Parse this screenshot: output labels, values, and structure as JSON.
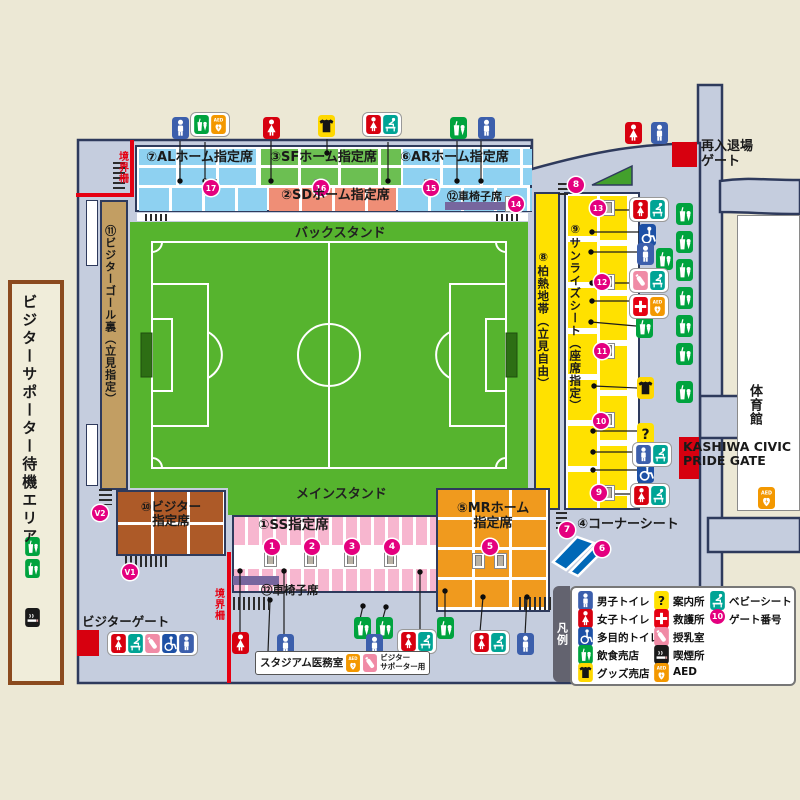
{
  "colors": {
    "background": "#ECE8D5",
    "concourse": "#C5CDDE",
    "outline": "#2E3A5C",
    "stand_blue": "#8ED1F1",
    "stand_green": "#6CBF52",
    "stand_salmon": "#EF8E76",
    "stand_pink": "#F7B6CF",
    "stand_orange": "#F09A1E",
    "stand_brown": "#AD5A28",
    "stand_tan": "#C29E63",
    "stand_yellow": "#FFE100",
    "field_green": "#56B42E",
    "gate_red": "#E60012",
    "gate_number_pink": "#E4007F",
    "wheelchair_bar_purple": "#77669E",
    "corner_seat_blue": "#0068B7"
  },
  "labels": {
    "back_stand": "バックスタンド",
    "main_stand": "メインスタンド",
    "reentry_gate": "再入退場\nゲート",
    "boundary_fence": "境界柵",
    "visitor_gate": "ビジターゲート",
    "visitor_waiting_area": "ビジターサポーター待機エリア",
    "stadium_medical_room": "スタジアム医務室",
    "for_visitor_supporters": "ビジター\nサポーター用",
    "kashiwa_civic_pride_gate": "KASHIWA CIVIC\nPRIDE GATE",
    "gymnasium": "体育館"
  },
  "stands": {
    "al": "⑦ALホーム指定席",
    "sf": "③SFホーム指定席",
    "ar": "⑥ARホーム指定席",
    "sd": "②SDホーム指定席",
    "wheelchair_top": "⑫車椅子席",
    "kashiwa_hot_zone": "⑧柏熱地帯（立見自由）",
    "sunrise_seat": "⑨サンライズシート（座席指定）",
    "visitor_goal_back": "⑪ビジターゴール裏（立見指定）",
    "visitor_reserved": "⑩ビジター\n指定席",
    "ss_reserved": "①SS指定席",
    "wheelchair_bottom": "⑫車椅子席",
    "mr_home": "⑤MRホーム\n指定席",
    "corner_seat": "④コーナーシート"
  },
  "legend": {
    "title": "凡例",
    "col1": [
      {
        "icon": "male",
        "label": "男子トイレ"
      },
      {
        "icon": "female",
        "label": "女子トイレ"
      },
      {
        "icon": "wheelchair",
        "label": "多目的トイレ"
      },
      {
        "icon": "food",
        "label": "飲食売店"
      },
      {
        "icon": "goods",
        "label": "グッズ売店"
      }
    ],
    "col2": [
      {
        "icon": "info",
        "label": "案内所"
      },
      {
        "icon": "firstaid",
        "label": "救護所"
      },
      {
        "icon": "nursing",
        "label": "授乳室"
      },
      {
        "icon": "smoking",
        "label": "喫煙所"
      },
      {
        "icon": "aed",
        "label": "AED"
      }
    ],
    "col3": [
      {
        "icon": "babyseat",
        "label": "ベビーシート"
      },
      {
        "icon": "gate10",
        "label": "ゲート番号"
      }
    ]
  },
  "gates": [
    {
      "n": "1",
      "x": 272,
      "y": 547
    },
    {
      "n": "2",
      "x": 312,
      "y": 547
    },
    {
      "n": "3",
      "x": 352,
      "y": 547
    },
    {
      "n": "4",
      "x": 392,
      "y": 547
    },
    {
      "n": "5",
      "x": 490,
      "y": 547
    },
    {
      "n": "6",
      "x": 602,
      "y": 549
    },
    {
      "n": "7",
      "x": 567,
      "y": 530
    },
    {
      "n": "8",
      "x": 576,
      "y": 185
    },
    {
      "n": "9",
      "x": 599,
      "y": 493
    },
    {
      "n": "10",
      "x": 601,
      "y": 421
    },
    {
      "n": "11",
      "x": 602,
      "y": 351
    },
    {
      "n": "12",
      "x": 602,
      "y": 282
    },
    {
      "n": "13",
      "x": 598,
      "y": 208
    },
    {
      "n": "14",
      "x": 516,
      "y": 204
    },
    {
      "n": "15",
      "x": 431,
      "y": 188
    },
    {
      "n": "16",
      "x": 321,
      "y": 188
    },
    {
      "n": "17",
      "x": 211,
      "y": 188
    },
    {
      "n": "V1",
      "x": 130,
      "y": 572
    },
    {
      "n": "V2",
      "x": 100,
      "y": 513
    }
  ],
  "map_icons": [
    {
      "t": "male",
      "x": 172,
      "y": 117
    },
    {
      "t": "female",
      "x": 263,
      "y": 117
    },
    {
      "t": "goods",
      "x": 318,
      "y": 115
    },
    {
      "t": "food",
      "x": 450,
      "y": 117
    },
    {
      "t": "male",
      "x": 478,
      "y": 117
    },
    {
      "t": "female",
      "x": 625,
      "y": 122
    },
    {
      "t": "male",
      "x": 651,
      "y": 122
    },
    {
      "t": "food",
      "x": 676,
      "y": 203
    },
    {
      "t": "food",
      "x": 676,
      "y": 231
    },
    {
      "t": "food",
      "x": 676,
      "y": 259
    },
    {
      "t": "food",
      "x": 676,
      "y": 287
    },
    {
      "t": "food",
      "x": 676,
      "y": 315
    },
    {
      "t": "food",
      "x": 676,
      "y": 343
    },
    {
      "t": "food",
      "x": 676,
      "y": 381
    },
    {
      "t": "wheelchair",
      "x": 639,
      "y": 224
    },
    {
      "t": "male",
      "x": 637,
      "y": 243
    },
    {
      "t": "food",
      "x": 656,
      "y": 248
    },
    {
      "t": "food",
      "x": 636,
      "y": 316
    },
    {
      "t": "goods",
      "x": 637,
      "y": 377
    },
    {
      "t": "info",
      "x": 637,
      "y": 423
    },
    {
      "t": "wheelchair",
      "x": 637,
      "y": 461
    },
    {
      "t": "food",
      "x": 25,
      "y": 537,
      "w": 15,
      "h": 19
    },
    {
      "t": "food",
      "x": 25,
      "y": 559,
      "w": 15,
      "h": 19
    },
    {
      "t": "smoking",
      "x": 25,
      "y": 608,
      "w": 15,
      "h": 19
    },
    {
      "t": "female",
      "x": 232,
      "y": 632
    },
    {
      "t": "male",
      "x": 277,
      "y": 634
    },
    {
      "t": "food",
      "x": 354,
      "y": 617
    },
    {
      "t": "food",
      "x": 376,
      "y": 617
    },
    {
      "t": "male",
      "x": 366,
      "y": 634
    },
    {
      "t": "food",
      "x": 437,
      "y": 617
    },
    {
      "t": "male",
      "x": 517,
      "y": 633
    },
    {
      "t": "aed",
      "x": 758,
      "y": 487
    }
  ],
  "pills": [
    {
      "x": 190,
      "y": 112,
      "icons": [
        "food",
        "aed"
      ]
    },
    {
      "x": 362,
      "y": 112,
      "icons": [
        "female",
        "babyseat"
      ]
    },
    {
      "x": 629,
      "y": 197,
      "icons": [
        "female",
        "babyseat"
      ]
    },
    {
      "x": 629,
      "y": 268,
      "icons": [
        "nursing",
        "babyseat"
      ]
    },
    {
      "x": 629,
      "y": 294,
      "icons": [
        "firstaid",
        "aed"
      ]
    },
    {
      "x": 632,
      "y": 442,
      "icons": [
        "male",
        "babyseat"
      ]
    },
    {
      "x": 630,
      "y": 483,
      "icons": [
        "female",
        "babyseat"
      ]
    },
    {
      "x": 397,
      "y": 629,
      "icons": [
        "female",
        "babyseat"
      ]
    },
    {
      "x": 470,
      "y": 630,
      "icons": [
        "female",
        "babyseat"
      ]
    },
    {
      "x": 107,
      "y": 631,
      "icons": [
        "female",
        "babyseat",
        "nursing",
        "wheelchair",
        "male"
      ]
    }
  ],
  "doors": [
    [
      204,
      179
    ],
    [
      314,
      179
    ],
    [
      424,
      179
    ],
    [
      505,
      196
    ],
    [
      602,
      200
    ],
    [
      602,
      274
    ],
    [
      602,
      343
    ],
    [
      602,
      412
    ],
    [
      602,
      485
    ],
    [
      264,
      551
    ],
    [
      304,
      551
    ],
    [
      344,
      551
    ],
    [
      384,
      551
    ],
    [
      472,
      553
    ],
    [
      494,
      553
    ]
  ],
  "stairs": [
    [
      113,
      162,
      12,
      28,
      "v"
    ],
    [
      99,
      489,
      13,
      16,
      "v"
    ],
    [
      125,
      556,
      42,
      11,
      "h"
    ],
    [
      233,
      597,
      36,
      13,
      "h"
    ],
    [
      519,
      597,
      36,
      13,
      "h"
    ],
    [
      556,
      512,
      11,
      17,
      "v"
    ],
    [
      558,
      183,
      10,
      15,
      "v"
    ],
    [
      145,
      214,
      24,
      7,
      "h"
    ],
    [
      496,
      214,
      24,
      7,
      "h"
    ]
  ],
  "connectors": [
    [
      180,
      181,
      180,
      141
    ],
    [
      205,
      181,
      205,
      142
    ],
    [
      271,
      181,
      271,
      141
    ],
    [
      327,
      153,
      327,
      139
    ],
    [
      388,
      181,
      388,
      142
    ],
    [
      457,
      181,
      457,
      141
    ],
    [
      481,
      181,
      481,
      141
    ],
    [
      593,
      210,
      629,
      210
    ],
    [
      592,
      232,
      639,
      232
    ],
    [
      591,
      252,
      642,
      252
    ],
    [
      592,
      283,
      629,
      283
    ],
    [
      592,
      301,
      629,
      301
    ],
    [
      591,
      322,
      636,
      326
    ],
    [
      594,
      386,
      637,
      388
    ],
    [
      593,
      431,
      637,
      431
    ],
    [
      593,
      452,
      632,
      452
    ],
    [
      593,
      470,
      637,
      470
    ],
    [
      593,
      494,
      630,
      494
    ],
    [
      240,
      571,
      240,
      634
    ],
    [
      284,
      571,
      284,
      637
    ],
    [
      363,
      606,
      360,
      619
    ],
    [
      386,
      607,
      378,
      636
    ],
    [
      420,
      572,
      420,
      631
    ],
    [
      270,
      600,
      268,
      652
    ],
    [
      445,
      591,
      445,
      619
    ],
    [
      483,
      597,
      480,
      632
    ],
    [
      527,
      597,
      525,
      635
    ]
  ]
}
